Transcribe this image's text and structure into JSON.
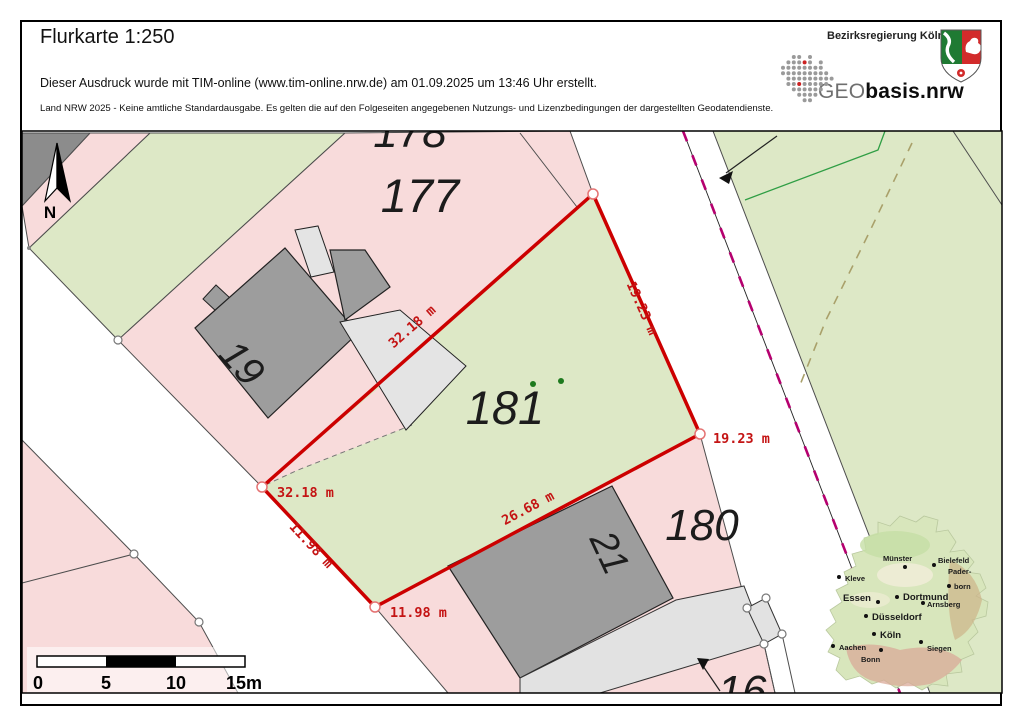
{
  "header": {
    "title": "Flurkarte 1:250",
    "created_line": "Dieser Ausdruck wurde mit TIM-online (www.tim-online.nrw.de) am 01.09.2025 um 13:46 Uhr erstellt.",
    "license_line": "Land NRW 2025 - Keine amtliche Standardausgabe. Es gelten die auf den Folgeseiten angegebenen Nutzungs- und Lizenzbedingungen der dargestellten Geodatendienste.",
    "agency": "Bezirksregierung Köln",
    "geo_logo": {
      "prefix": "GEO",
      "suffix": "basis.nrw"
    }
  },
  "map": {
    "north_label": "N",
    "parcels": {
      "p177": "177",
      "p178": "178",
      "p180": "180",
      "p181": "181",
      "p16": "16"
    },
    "buildings": {
      "b19": "19",
      "b21": "21"
    },
    "measurements": {
      "nw": "32.18 m",
      "ne": "19.23 m",
      "se": "26.68 m",
      "sw": "11.98 m",
      "vertex_w": "32.18 m",
      "vertex_e": "19.23 m",
      "vertex_s": "11.98 m"
    },
    "scalebar": {
      "t0": "0",
      "t5": "5",
      "t10": "10",
      "t15": "15m"
    },
    "colors": {
      "parcel_pink": "#f8dbdb",
      "parcel_green": "#dde8c6",
      "building_dark": "#9d9d9d",
      "building_light": "#e4e4e4",
      "boundary_red": "#cc0000",
      "label_red": "#c41414",
      "rail_magenta": "#b5006f"
    }
  },
  "inset": {
    "cities": [
      {
        "name": "Kleve",
        "lx": 845,
        "ly": 581,
        "dx": 839,
        "dy": 577,
        "big": false
      },
      {
        "name": "Münster",
        "lx": 883,
        "ly": 561,
        "dx": 905,
        "dy": 567,
        "big": false
      },
      {
        "name": "Bielefeld",
        "lx": 938,
        "ly": 563,
        "dx": 934,
        "dy": 565,
        "big": false
      },
      {
        "name": "Pader-",
        "lx": 948,
        "ly": 574,
        "dx": -1,
        "dy": -1,
        "big": false
      },
      {
        "name": "born",
        "lx": 954,
        "ly": 589,
        "dx": 949,
        "dy": 586,
        "big": false
      },
      {
        "name": "Essen",
        "lx": 843,
        "ly": 601,
        "dx": 878,
        "dy": 602,
        "big": true
      },
      {
        "name": "Dortmund",
        "lx": 903,
        "ly": 600,
        "dx": 897,
        "dy": 597,
        "big": true
      },
      {
        "name": "Arnsberg",
        "lx": 927,
        "ly": 607,
        "dx": 923,
        "dy": 603,
        "big": false
      },
      {
        "name": "Düsseldorf",
        "lx": 872,
        "ly": 620,
        "dx": 866,
        "dy": 616,
        "big": true
      },
      {
        "name": "Köln",
        "lx": 880,
        "ly": 638,
        "dx": 874,
        "dy": 634,
        "big": true
      },
      {
        "name": "Aachen",
        "lx": 839,
        "ly": 650,
        "dx": 833,
        "dy": 646,
        "big": false
      },
      {
        "name": "Bonn",
        "lx": 861,
        "ly": 662,
        "dx": 881,
        "dy": 650,
        "big": false
      },
      {
        "name": "Siegen",
        "lx": 927,
        "ly": 651,
        "dx": 921,
        "dy": 642,
        "big": false
      }
    ]
  }
}
